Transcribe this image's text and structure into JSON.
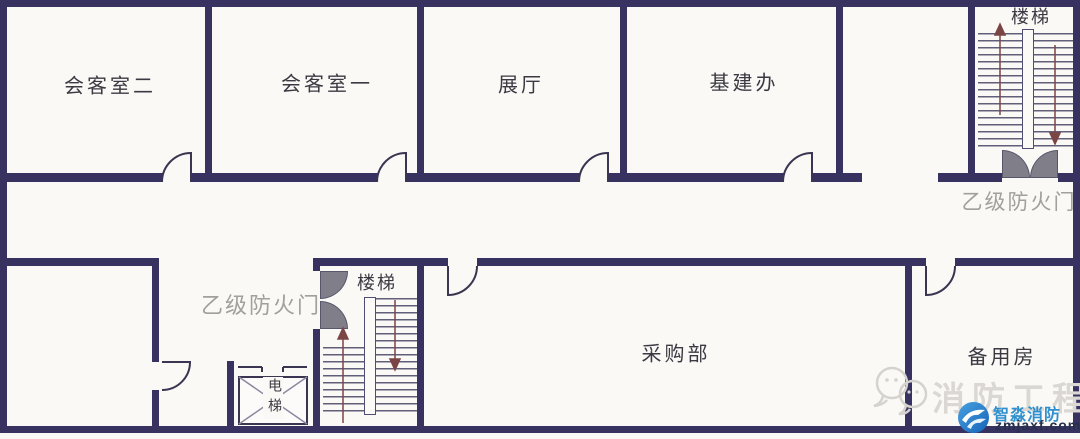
{
  "floorplan": {
    "rooms": [
      {
        "id": "meeting-room-2",
        "label": "会客室二"
      },
      {
        "id": "meeting-room-1",
        "label": "会客室一"
      },
      {
        "id": "exhibition-hall",
        "label": "展厅"
      },
      {
        "id": "infrastructure-office",
        "label": "基建办"
      },
      {
        "id": "purchasing-dept",
        "label": "采购部"
      },
      {
        "id": "spare-room",
        "label": "备用房"
      }
    ],
    "stairs": {
      "top_right_label": "楼梯",
      "middle_label": "楼梯"
    },
    "elevator": {
      "label": "电梯"
    },
    "fire_doors": {
      "top_right_label": "乙级防火门",
      "middle_label": "乙级防火门"
    }
  },
  "watermark": {
    "text": "消防工程"
  },
  "logo": {
    "brand": "智淼消防",
    "domain": "zmjaxf.com"
  },
  "colors": {
    "wall": "#37325f",
    "line": "#3a3550",
    "fire_door_fill": "#7f7e89",
    "gray_label": "#a39f9a",
    "brand_blue": "#3090cf",
    "brand_dark": "#25304d",
    "arrow": "#7b4545"
  }
}
